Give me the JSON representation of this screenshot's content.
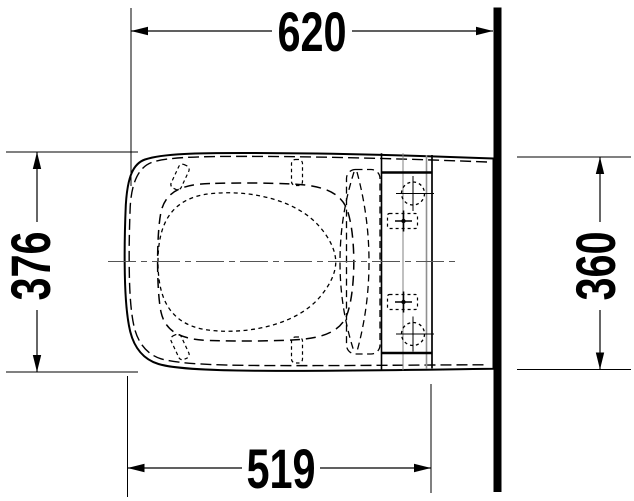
{
  "drawing": {
    "title": "toilet-top-view-dimension-drawing",
    "dimensions": {
      "top_width": "620",
      "left_depth": "376",
      "right_depth": "360",
      "bottom_width": "519"
    }
  },
  "colors": {
    "line": "#000000",
    "thin_construction_line": "#666666",
    "background": "#ffffff"
  }
}
